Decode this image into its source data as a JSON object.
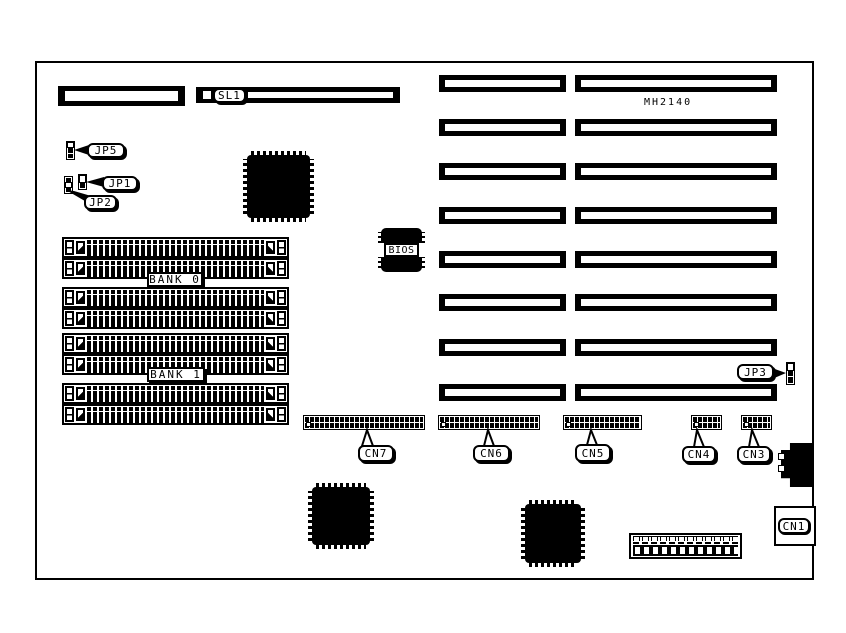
{
  "board": {
    "model": "MH2140"
  },
  "slots": {
    "sl1": "SL1"
  },
  "memory": {
    "bank0": "BANK 0",
    "bank1": "BANK 1"
  },
  "chips": {
    "bios": "BIOS"
  },
  "jumpers": {
    "jp1": "JP1",
    "jp2": "JP2",
    "jp3": "JP3",
    "jp5": "JP5"
  },
  "connectors": {
    "cn1": "CN1",
    "cn3": "CN3",
    "cn4": "CN4",
    "cn5": "CN5",
    "cn6": "CN6",
    "cn7": "CN7"
  },
  "colors": {
    "foreground": "#000000",
    "background": "#ffffff"
  }
}
